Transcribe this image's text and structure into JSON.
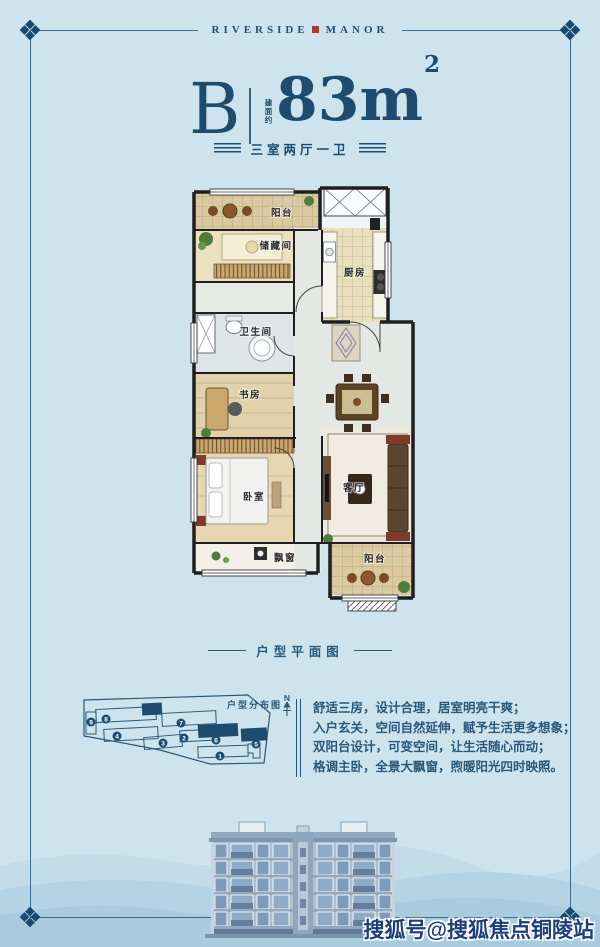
{
  "brand": {
    "name_left": "RIVERSIDE",
    "name_right": "MANOR"
  },
  "unit": {
    "letter": "B",
    "area_prefix": "建面约",
    "area_value": "83m",
    "area_sup": "2",
    "layout": "三室两厅一卫"
  },
  "floor_plan": {
    "caption": "户型平面图",
    "rooms": {
      "balcony_top": "阳台",
      "storage": "储藏间",
      "kitchen": "厨房",
      "bathroom": "卫生间",
      "study": "书房",
      "bedroom": "卧室",
      "bay_window": "飘窗",
      "living_room": "客厅",
      "balcony_bottom": "阳台"
    }
  },
  "site_plan": {
    "label": "户型分布图",
    "compass": "N",
    "building_numbers": [
      "9",
      "8",
      "4",
      "7",
      "3",
      "2",
      "6",
      "5",
      "1"
    ]
  },
  "description": {
    "lines": [
      "舒适三房，设计合理，居室明亮干爽；",
      "入户玄关，空间自然延伸，赋予生活更多想象；",
      "双阳台设计，可变空间，让生活随心而动；",
      "格调主卧，全景大飘窗，煦暖阳光四时映照。"
    ]
  },
  "watermark": "搜狐号@搜狐焦点铜陵站",
  "colors": {
    "background": "#cde4ee",
    "navy": "#1d4c6e",
    "accent_red": "#a93c2e",
    "wall": "#1f1f1f",
    "highlight_building": "#1d4d6e"
  }
}
